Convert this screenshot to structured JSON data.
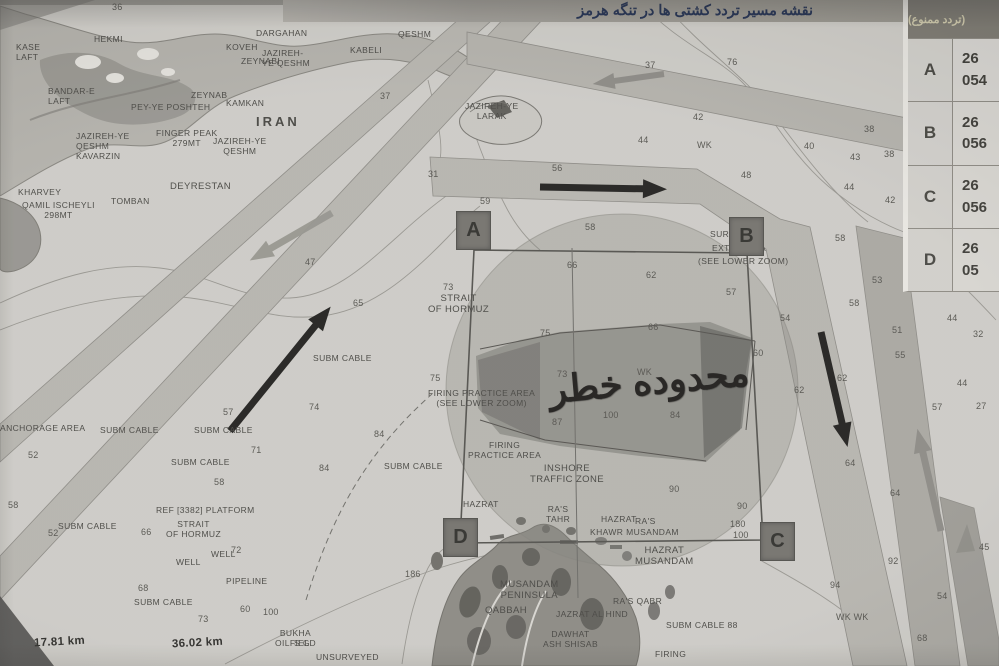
{
  "title_bar": {
    "text": "نقشه مسیر تردد کشتی ها در تنگه هرمز"
  },
  "danger_zone": {
    "label": "محدوده خطر"
  },
  "coords_table": {
    "header": "(تردد ممنوع)",
    "rows": [
      {
        "point": "A",
        "line1": "26",
        "line2": "054"
      },
      {
        "point": "B",
        "line1": "26",
        "line2": "056"
      },
      {
        "point": "C",
        "line1": "26",
        "line2": "056"
      },
      {
        "point": "D",
        "line1": "26",
        "line2": "05"
      }
    ]
  },
  "markers": [
    {
      "id": "A",
      "x": 456,
      "y": 211
    },
    {
      "id": "B",
      "x": 729,
      "y": 217
    },
    {
      "id": "C",
      "x": 760,
      "y": 522
    },
    {
      "id": "D",
      "x": 443,
      "y": 518
    }
  ],
  "scale_labels": [
    {
      "t": "17.81 km",
      "x": 34,
      "y": 636
    },
    {
      "t": "36.02 km",
      "x": 172,
      "y": 637
    }
  ],
  "place_labels": [
    {
      "t": "KASE\nLAFT",
      "x": 16,
      "y": 42
    },
    {
      "t": "HEKMI",
      "x": 94,
      "y": 34
    },
    {
      "t": "BANDAR-E\nLAFT",
      "x": 48,
      "y": 86
    },
    {
      "t": "DARGAHAN",
      "x": 256,
      "y": 28
    },
    {
      "t": "KOVEH",
      "x": 226,
      "y": 42
    },
    {
      "t": "ZEYNABI",
      "x": 241,
      "y": 56
    },
    {
      "t": "JAZIREH-\nYE QESHM",
      "x": 262,
      "y": 48
    },
    {
      "t": "KAPOLI",
      "x": 348,
      "y": 14
    },
    {
      "t": "QESHM",
      "x": 398,
      "y": 29
    },
    {
      "t": "KABELI",
      "x": 350,
      "y": 45
    },
    {
      "t": "ZEYNAB",
      "x": 191,
      "y": 90
    },
    {
      "t": "PEY-YE POSHTEH",
      "x": 131,
      "y": 102
    },
    {
      "t": "KAMKAN",
      "x": 226,
      "y": 98
    },
    {
      "t": "IRAN",
      "x": 256,
      "y": 114,
      "fs": 13,
      "b": 1,
      "ls": 3
    },
    {
      "t": "FINGER PEAK\n279MT",
      "x": 156,
      "y": 128,
      "cls": "c"
    },
    {
      "t": "JAZIREH-YE\nQESHM",
      "x": 213,
      "y": 136,
      "cls": "c"
    },
    {
      "t": "JAZIREH-YE\nQESHM\nKAVARZIN",
      "x": 76,
      "y": 131
    },
    {
      "t": "KHARVEY",
      "x": 18,
      "y": 187
    },
    {
      "t": "QAMIL ISCHEYLI\n298MT",
      "x": 22,
      "y": 200,
      "cls": "c"
    },
    {
      "t": "TOMBAN",
      "x": 111,
      "y": 196
    },
    {
      "t": "DEYRESTAN",
      "x": 170,
      "y": 181,
      "fs": 9.5
    },
    {
      "t": "JAZIREH-YE\nLARAK",
      "x": 465,
      "y": 101,
      "cls": "c"
    },
    {
      "t": "STRAIT\nOF HORMUZ",
      "x": 428,
      "y": 293,
      "fs": 9.5,
      "cls": "c"
    },
    {
      "t": "SUBM CABLE",
      "x": 313,
      "y": 353
    },
    {
      "t": "SUBM CABLE",
      "x": 100,
      "y": 425
    },
    {
      "t": "SUBM CABLE",
      "x": 194,
      "y": 425
    },
    {
      "t": "SUBM CABLE",
      "x": 171,
      "y": 457
    },
    {
      "t": "SUBM CABLE",
      "x": 58,
      "y": 521
    },
    {
      "t": "SUBM CABLE",
      "x": 384,
      "y": 461
    },
    {
      "t": "SUBM CABLE",
      "x": 134,
      "y": 597
    },
    {
      "t": "SUBM CABLE 88",
      "x": 666,
      "y": 620
    },
    {
      "t": "ANCHORAGE AREA",
      "x": 0,
      "y": 423
    },
    {
      "t": "REF [3382] PLATFORM",
      "x": 156,
      "y": 505
    },
    {
      "t": "STRAIT\nOF HORMUZ",
      "x": 166,
      "y": 519,
      "cls": "c"
    },
    {
      "t": "WELL",
      "x": 211,
      "y": 549
    },
    {
      "t": "WELL",
      "x": 176,
      "y": 557
    },
    {
      "t": "PIPELINE",
      "x": 226,
      "y": 576
    },
    {
      "t": "FIRING PRACTICE AREA\n(SEE LOWER ZOOM)",
      "x": 428,
      "y": 388,
      "cls": "c"
    },
    {
      "t": "FIRING\nPRACTICE AREA",
      "x": 468,
      "y": 440,
      "cls": "c"
    },
    {
      "t": "INSHORE\nTRAFFIC ZONE",
      "x": 530,
      "y": 463,
      "fs": 9.5,
      "cls": "c"
    },
    {
      "t": "RA'S\nTAHR",
      "x": 546,
      "y": 504,
      "cls": "c"
    },
    {
      "t": "HAZRAT",
      "x": 463,
      "y": 499
    },
    {
      "t": "HAZRAT",
      "x": 601,
      "y": 514
    },
    {
      "t": "RA'S",
      "x": 635,
      "y": 516
    },
    {
      "t": "KHAWR MUSANDAM",
      "x": 590,
      "y": 527
    },
    {
      "t": "HAZRAT\nMUSANDAM",
      "x": 635,
      "y": 545,
      "fs": 9.5,
      "cls": "c"
    },
    {
      "t": "MUSANDAM\nPENINSULA",
      "x": 500,
      "y": 579,
      "fs": 9.5,
      "cls": "c"
    },
    {
      "t": "QABBAH",
      "x": 485,
      "y": 605,
      "fs": 9.5
    },
    {
      "t": "RA'S QABR",
      "x": 613,
      "y": 596
    },
    {
      "t": "JAZRAT AL HIND",
      "x": 556,
      "y": 609
    },
    {
      "t": "DAWHAT\nASH SHISAB",
      "x": 543,
      "y": 629,
      "cls": "c"
    },
    {
      "t": "FIRING",
      "x": 655,
      "y": 649
    },
    {
      "t": "BUKHA\nOILFIELD",
      "x": 275,
      "y": 628,
      "cls": "c"
    },
    {
      "t": "S G",
      "x": 294,
      "y": 638
    },
    {
      "t": "UNSURVEYED",
      "x": 316,
      "y": 652
    },
    {
      "t": "SURF",
      "x": 710,
      "y": 229
    },
    {
      "t": "EXTD. AREA",
      "x": 712,
      "y": 243
    },
    {
      "t": "(SEE LOWER ZOOM)",
      "x": 698,
      "y": 256
    }
  ],
  "depth_numbers": [
    {
      "t": "36",
      "x": 112,
      "y": 2
    },
    {
      "t": "37",
      "x": 645,
      "y": 60
    },
    {
      "t": "76",
      "x": 727,
      "y": 57
    },
    {
      "t": "37",
      "x": 380,
      "y": 91
    },
    {
      "t": "31",
      "x": 428,
      "y": 169
    },
    {
      "t": "56",
      "x": 552,
      "y": 163
    },
    {
      "t": "59",
      "x": 480,
      "y": 196
    },
    {
      "t": "58",
      "x": 585,
      "y": 222
    },
    {
      "t": "48",
      "x": 741,
      "y": 170
    },
    {
      "t": "42",
      "x": 693,
      "y": 112
    },
    {
      "t": "44",
      "x": 638,
      "y": 135
    },
    {
      "t": "WK",
      "x": 697,
      "y": 140
    },
    {
      "t": "40",
      "x": 804,
      "y": 141
    },
    {
      "t": "43",
      "x": 850,
      "y": 152
    },
    {
      "t": "38",
      "x": 864,
      "y": 124
    },
    {
      "t": "38",
      "x": 884,
      "y": 149
    },
    {
      "t": "44",
      "x": 844,
      "y": 182
    },
    {
      "t": "42",
      "x": 885,
      "y": 195
    },
    {
      "t": "58",
      "x": 835,
      "y": 233
    },
    {
      "t": "53",
      "x": 872,
      "y": 275
    },
    {
      "t": "58",
      "x": 849,
      "y": 298
    },
    {
      "t": "51",
      "x": 892,
      "y": 325
    },
    {
      "t": "55",
      "x": 895,
      "y": 350
    },
    {
      "t": "54",
      "x": 780,
      "y": 313
    },
    {
      "t": "62",
      "x": 794,
      "y": 385
    },
    {
      "t": "62",
      "x": 837,
      "y": 373
    },
    {
      "t": "64",
      "x": 845,
      "y": 458
    },
    {
      "t": "64",
      "x": 890,
      "y": 488
    },
    {
      "t": "57",
      "x": 932,
      "y": 402
    },
    {
      "t": "44",
      "x": 947,
      "y": 313
    },
    {
      "t": "32",
      "x": 973,
      "y": 329
    },
    {
      "t": "44",
      "x": 957,
      "y": 378
    },
    {
      "t": "27",
      "x": 976,
      "y": 401
    },
    {
      "t": "92",
      "x": 888,
      "y": 556
    },
    {
      "t": "94",
      "x": 830,
      "y": 580
    },
    {
      "t": "54",
      "x": 937,
      "y": 591
    },
    {
      "t": "WK WK",
      "x": 836,
      "y": 612
    },
    {
      "t": "68",
      "x": 917,
      "y": 633
    },
    {
      "t": "45",
      "x": 979,
      "y": 542
    },
    {
      "t": "90",
      "x": 669,
      "y": 484
    },
    {
      "t": "90",
      "x": 737,
      "y": 501
    },
    {
      "t": "180",
      "x": 730,
      "y": 519
    },
    {
      "t": "100",
      "x": 733,
      "y": 530
    },
    {
      "t": "66",
      "x": 567,
      "y": 260
    },
    {
      "t": "62",
      "x": 646,
      "y": 270
    },
    {
      "t": "57",
      "x": 726,
      "y": 287
    },
    {
      "t": "75",
      "x": 540,
      "y": 328
    },
    {
      "t": "66",
      "x": 648,
      "y": 322
    },
    {
      "t": "60",
      "x": 753,
      "y": 348
    },
    {
      "t": "73",
      "x": 557,
      "y": 369
    },
    {
      "t": "WK",
      "x": 637,
      "y": 367
    },
    {
      "t": "84",
      "x": 670,
      "y": 410
    },
    {
      "t": "87",
      "x": 552,
      "y": 417
    },
    {
      "t": "100",
      "x": 603,
      "y": 410
    },
    {
      "t": "75",
      "x": 430,
      "y": 373
    },
    {
      "t": "74",
      "x": 309,
      "y": 402
    },
    {
      "t": "84",
      "x": 374,
      "y": 429
    },
    {
      "t": "84",
      "x": 319,
      "y": 463
    },
    {
      "t": "65",
      "x": 353,
      "y": 298
    },
    {
      "t": "47",
      "x": 305,
      "y": 257
    },
    {
      "t": "57",
      "x": 223,
      "y": 407
    },
    {
      "t": "71",
      "x": 251,
      "y": 445
    },
    {
      "t": "58",
      "x": 214,
      "y": 477
    },
    {
      "t": "52",
      "x": 28,
      "y": 450
    },
    {
      "t": "58",
      "x": 8,
      "y": 500
    },
    {
      "t": "52",
      "x": 48,
      "y": 528
    },
    {
      "t": "66",
      "x": 141,
      "y": 527
    },
    {
      "t": "72",
      "x": 231,
      "y": 545
    },
    {
      "t": "68",
      "x": 138,
      "y": 583
    },
    {
      "t": "73",
      "x": 198,
      "y": 614
    },
    {
      "t": "60",
      "x": 240,
      "y": 604
    },
    {
      "t": "100",
      "x": 263,
      "y": 607
    },
    {
      "t": "186",
      "x": 405,
      "y": 569
    },
    {
      "t": "73",
      "x": 443,
      "y": 282
    }
  ],
  "colors": {
    "paper": "#ceccc7",
    "lane": "#b6b4ae",
    "ink": "#45443f",
    "title_ink": "#1d2c50",
    "title_band": "#a09d97",
    "table_header_bg": "#7b7870",
    "danger_ink": "#1c1b19"
  }
}
